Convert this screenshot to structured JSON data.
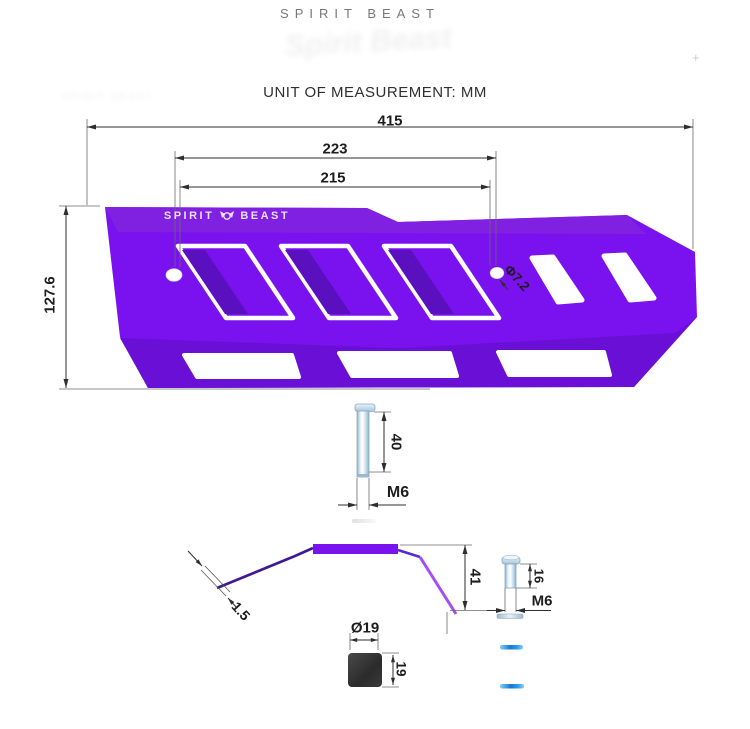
{
  "header": {
    "brand": "SPIRIT BEAST",
    "unit_label": "UNIT OF MEASUREMENT: MM",
    "watermark": "Spirit Beast",
    "watermark_small": "SPIRIT BEAST",
    "plus_mark": "+"
  },
  "part": {
    "logo_left": "SPIRIT",
    "logo_right": "BEAST",
    "description": "Exhaust heat shield guard plate, purple, with slotted vents and mounting holes"
  },
  "dimensions": {
    "overall_width": "415",
    "hole_spacing_outer": "223",
    "hole_spacing_inner": "215",
    "overall_height": "127.6",
    "hole_diameter": "Φ7.2",
    "long_bolt_length": "40",
    "long_bolt_thread": "M6",
    "profile_height": "41",
    "sheet_thickness": "1.5",
    "short_bolt_length": "16",
    "short_bolt_thread": "M6",
    "rubber_diameter": "Ø19",
    "rubber_height": "19"
  },
  "colors": {
    "purple_main": "#7a12ef",
    "purple_top": "#8021e2",
    "purple_bottom": "#6a10d6",
    "slot_shadow": "#5a10bf",
    "profile_dark": "#3f1895",
    "profile_accent": "#a44df5",
    "dim_line": "#2e2e2e",
    "blue_strip": "#1e88e5",
    "rubber_dark": "#333333"
  }
}
